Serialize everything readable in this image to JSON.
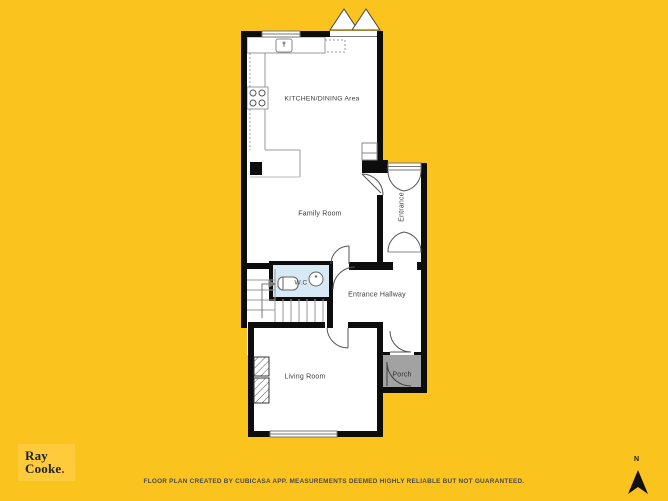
{
  "page": {
    "background_color": "#FBC31D"
  },
  "floor_plan": {
    "rooms": [
      {
        "id": "kitchen-dining",
        "label": "KITCHEN/DINING Area"
      },
      {
        "id": "family-room",
        "label": "Family Room"
      },
      {
        "id": "entrance",
        "label": "Entrance"
      },
      {
        "id": "wc",
        "label": "W.C"
      },
      {
        "id": "entrance-hallway",
        "label": "Entrance Hallway"
      },
      {
        "id": "living-room",
        "label": "Living Room"
      },
      {
        "id": "porch",
        "label": "Porch"
      }
    ],
    "colors": {
      "wall": "#0d0d0d",
      "room_fill": "#ffffff",
      "wc_floor_fill": "#d8e9f6",
      "porch_fill": "#a2a2a2",
      "fixture_line": "#999999",
      "door_line": "#555555"
    }
  },
  "branding": {
    "logo_line1": "Ray",
    "logo_line2": "Cooke",
    "logo_period": ".",
    "logo_bg": "#FFCB3B",
    "logo_text_color": "#20242F",
    "logo_period_color": "#D62027"
  },
  "footer": {
    "disclaimer": "FLOOR PLAN CREATED BY CUBICASA APP. MEASUREMENTS DEEMED HIGHLY RELIABLE BUT NOT GUARANTEED."
  },
  "compass": {
    "north_label": "N"
  }
}
